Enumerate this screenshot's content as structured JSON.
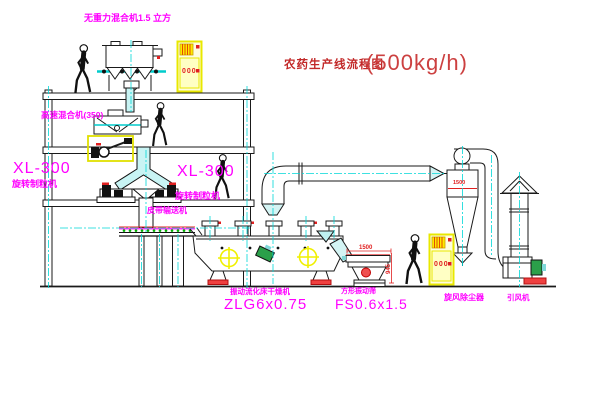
{
  "title": {
    "text": "农药生产线流程图",
    "capacity": "(500kg/h)"
  },
  "equipment": {
    "gravity_mixer": {
      "label": "无重力混合机1.5 立方"
    },
    "high_speed_mixer": {
      "label": "高速混合机(350)"
    },
    "granulator_left": {
      "model": "XL-300",
      "name": "旋转制粒机"
    },
    "granulator_right": {
      "model": "XL-300",
      "name": "旋转制粒机"
    },
    "belt_conveyor": {
      "name": "皮带输送机"
    },
    "fluid_bed_dryer": {
      "name": "振动流化床干燥机",
      "model": "ZLG6x0.75"
    },
    "vibrating_screen": {
      "name": "方形振动筛",
      "model": "FS0.6x1.5",
      "dim_width": "1500",
      "dim_height": "945"
    },
    "cyclone": {
      "name": "旋风除尘器",
      "dim": "1500"
    },
    "fan": {
      "name": "引风机"
    },
    "control_cabinet_top": {
      "display": "000"
    },
    "control_cabinet_right": {
      "display": "000"
    }
  },
  "colors": {
    "background": "#ffffff",
    "line_black": "#1a1a1a",
    "centerline_cyan": "#00d8d8",
    "pipe_fill_cyan": "#c8f4f4",
    "label_magenta": "#ff00ff",
    "title_red": "#c22828",
    "dim_red": "#e02020",
    "cabinet_yellow": "#f0e800",
    "motor_yellow": "#f0f000",
    "motor_green": "#2ba04a",
    "foot_red": "#ef4040",
    "belt_green": "#00b000"
  }
}
